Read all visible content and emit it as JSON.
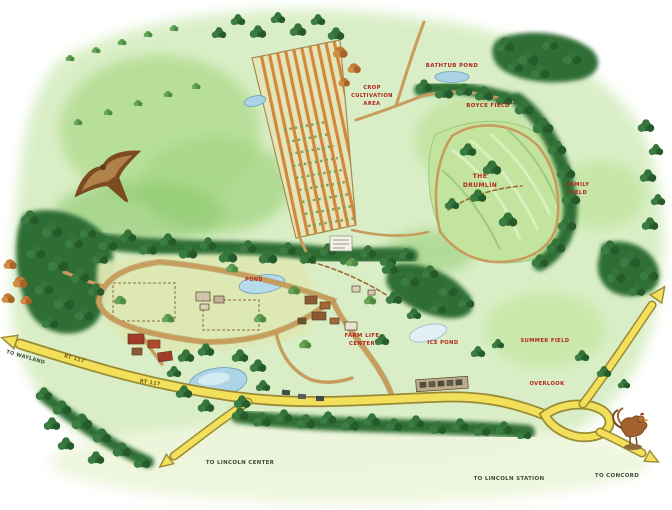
{
  "map": {
    "type": "illustrated-site-map",
    "labels": {
      "bathtub_pond": "BATHTUB POND",
      "boyce_field": "BOYCE FIELD",
      "crop_area": [
        "CROP",
        "CULTIVATION",
        "AREA"
      ],
      "the_drumlin": [
        "THE",
        "DRUMLIN"
      ],
      "family_field": [
        "FAMILY",
        "FIELD"
      ],
      "summer_field": "SUMMER FIELD",
      "overlook": "OVERLOOK",
      "ice_pond": "ICE POND",
      "farm_life_center": [
        "FARM LIFE",
        "CENTER"
      ],
      "farm_pond": "POND",
      "to_wayland": "TO WAYLAND",
      "route_marker_1": "RT 117",
      "route_marker_2": "RT 117",
      "to_lincoln_center": "TO LINCOLN CENTER",
      "to_lincoln_station": "TO LINCOLN STATION",
      "to_concord": "TO CONCORD"
    },
    "colors": {
      "background": "#ffffff",
      "field_light": "#d8eec4",
      "field_mid": "#b2dd92",
      "forest_dark": "#2e6b34",
      "road_yellow": "#f2df5a",
      "path_tan": "#c79c5c",
      "water_blue": "#abd3e6",
      "label_red": "#b3261e",
      "crop_orange": "#d4883c"
    }
  }
}
